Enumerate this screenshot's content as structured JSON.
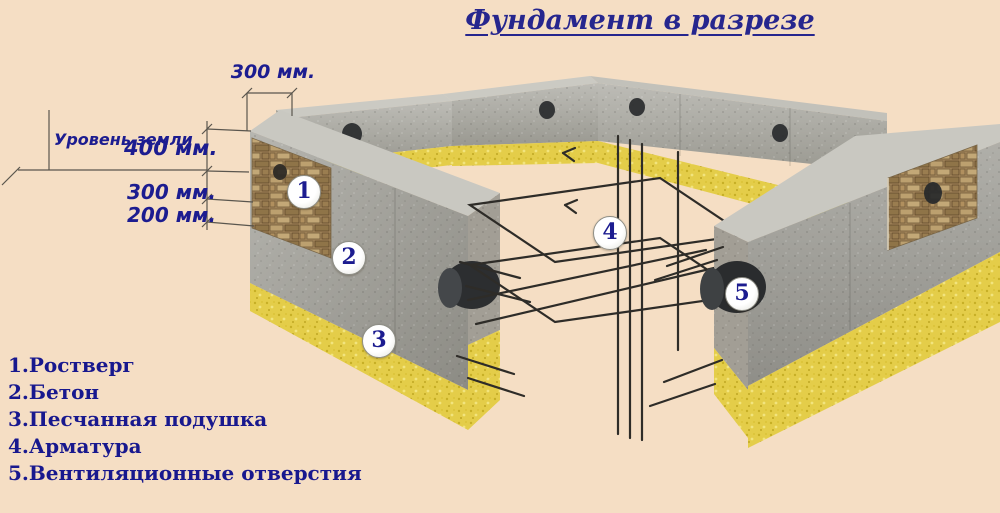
{
  "title": {
    "text": "Фундамент в разрезе"
  },
  "dimensions": {
    "wall_top_width": "300 мм.",
    "above_ground_height": "400 мм.",
    "below_ground_concrete": "300 мм.",
    "sand_layer": "200 мм.",
    "ground_level_label": "Уровень земли"
  },
  "callouts": {
    "c1": "1",
    "c2": "2",
    "c3": "3",
    "c4": "4",
    "c5": "5"
  },
  "legend": {
    "items": [
      "1.Ростверг",
      "2.Бетон",
      "3.Песчанная подушка",
      "4.Арматура",
      "5.Вентиляционные отверстия"
    ]
  },
  "colors": {
    "background": "#F5DEC4",
    "text_navy": "#1C1C90",
    "concrete_gray": "#A8A7A1",
    "concrete_top": "#C9C8C1",
    "sand_yellow": "#E4CD49",
    "masonry_tan": "#A5875B",
    "vent_dark": "#26282A",
    "rebar_dark": "#2E2C28"
  }
}
